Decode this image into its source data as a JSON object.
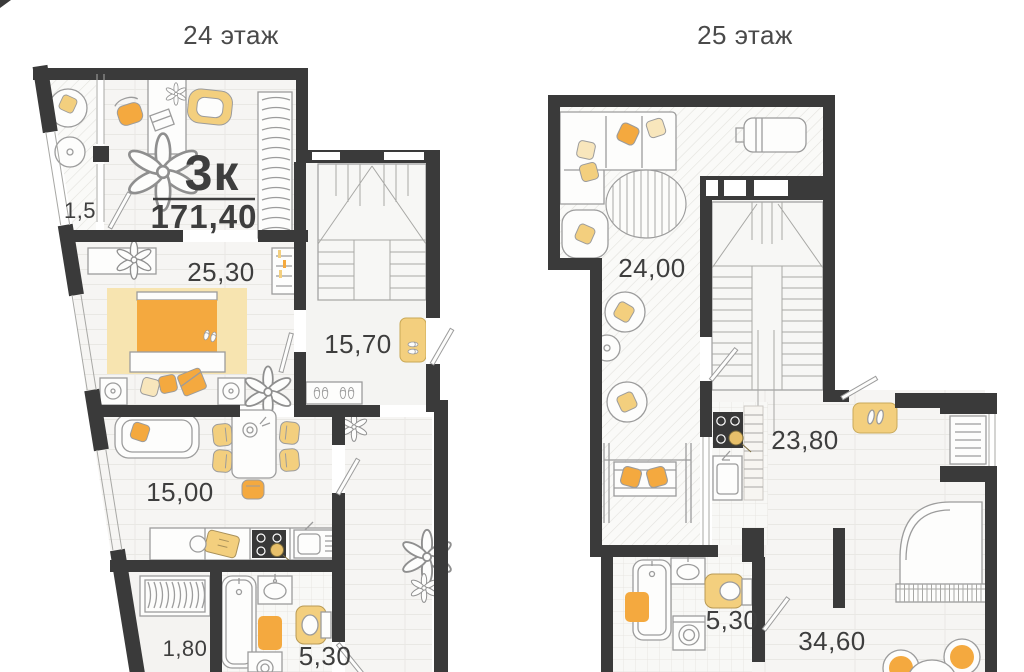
{
  "colors": {
    "wall": "#3a3a3a",
    "orange": "#f4a93f",
    "yellow": "#f3cf7e",
    "pale": "#f8e6bc",
    "rug": "#f7e4b0",
    "line": "#9c9c9c",
    "text": "#3e3e3e",
    "title": "#4a4a4a",
    "floor": "#f5f4f2"
  },
  "floor24": {
    "title": "24 этаж",
    "apartment": {
      "type": "3к",
      "total_area": "171,40"
    },
    "rooms": [
      {
        "name": "balcony",
        "area": "1,5"
      },
      {
        "name": "bedroom",
        "area": "25,30"
      },
      {
        "name": "stair-hall",
        "area": "15,70"
      },
      {
        "name": "living-room",
        "area": "15,00"
      },
      {
        "name": "wardrobe",
        "area": "1,80"
      },
      {
        "name": "bathroom",
        "area": "5,30"
      }
    ]
  },
  "floor25": {
    "title": "25 этаж",
    "rooms": [
      {
        "name": "terrace-lounge",
        "area": "24,00"
      },
      {
        "name": "kitchen-hall",
        "area": "23,80"
      },
      {
        "name": "bathroom",
        "area": "5,30"
      },
      {
        "name": "living-room",
        "area": "34,60"
      }
    ]
  }
}
